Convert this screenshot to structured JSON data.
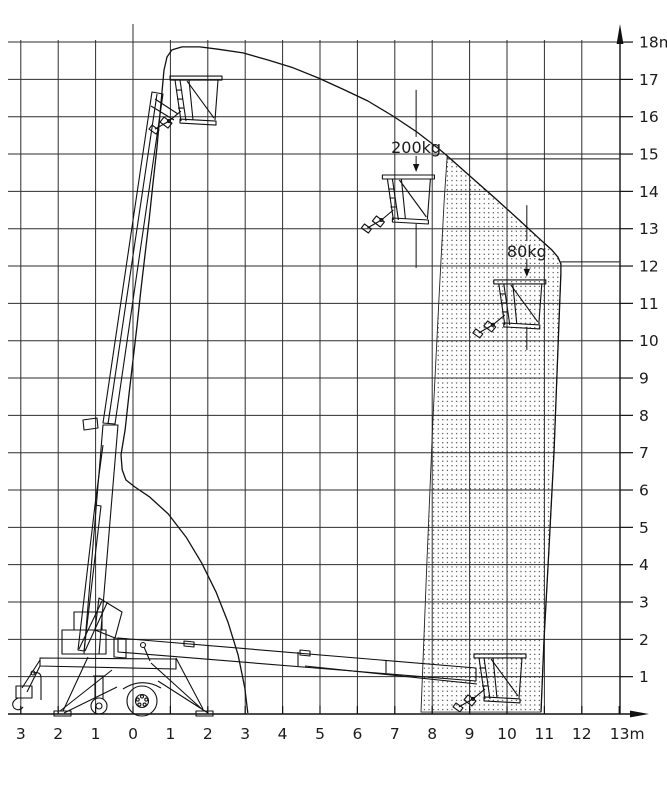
{
  "figure": {
    "kind": "aerial-work-platform-working-range-diagram"
  },
  "chart_data": {
    "type": "area",
    "grid": true,
    "x_axis": {
      "unit": "m",
      "tick_values": [
        -3,
        -2,
        -1,
        0,
        1,
        2,
        3,
        4,
        5,
        6,
        7,
        8,
        9,
        10,
        11,
        12,
        13
      ],
      "tick_labels": [
        "3",
        "2",
        "1",
        "0",
        "1",
        "2",
        "3",
        "4",
        "5",
        "6",
        "7",
        "8",
        "9",
        "10",
        "11",
        "12",
        "13m"
      ]
    },
    "y_axis": {
      "unit": "m",
      "tick_values": [
        1,
        2,
        3,
        4,
        5,
        6,
        7,
        8,
        9,
        10,
        11,
        12,
        13,
        14,
        15,
        16,
        17,
        18
      ],
      "tick_labels": [
        "1",
        "2",
        "3",
        "4",
        "5",
        "6",
        "7",
        "8",
        "9",
        "10",
        "11",
        "12",
        "13",
        "14",
        "15",
        "16",
        "17",
        "18m"
      ]
    },
    "envelope_m": [
      [
        3.07,
        0.03
      ],
      [
        2.99,
        0.7
      ],
      [
        2.81,
        1.58
      ],
      [
        2.54,
        2.46
      ],
      [
        2.22,
        3.27
      ],
      [
        1.84,
        4.04
      ],
      [
        1.42,
        4.74
      ],
      [
        0.94,
        5.36
      ],
      [
        0.45,
        5.81
      ],
      [
        0.05,
        6.08
      ],
      [
        -0.19,
        6.27
      ],
      [
        -0.29,
        6.54
      ],
      [
        -0.32,
        6.94
      ],
      [
        -0.21,
        7.61
      ],
      [
        -0.11,
        8.54
      ],
      [
        0.0,
        9.48
      ],
      [
        0.11,
        10.42
      ],
      [
        0.21,
        11.36
      ],
      [
        0.32,
        12.3
      ],
      [
        0.43,
        13.23
      ],
      [
        0.53,
        14.17
      ],
      [
        0.64,
        15.16
      ],
      [
        0.72,
        16.05
      ],
      [
        0.78,
        16.72
      ],
      [
        0.83,
        17.25
      ],
      [
        0.91,
        17.6
      ],
      [
        1.04,
        17.79
      ],
      [
        1.31,
        17.87
      ],
      [
        1.79,
        17.87
      ],
      [
        2.27,
        17.81
      ],
      [
        2.94,
        17.71
      ],
      [
        3.61,
        17.52
      ],
      [
        4.28,
        17.31
      ],
      [
        4.95,
        17.04
      ],
      [
        5.61,
        16.74
      ],
      [
        6.28,
        16.42
      ],
      [
        6.95,
        16.02
      ],
      [
        7.59,
        15.59
      ],
      [
        8.21,
        15.11
      ],
      [
        8.4,
        14.95
      ],
      [
        9.01,
        14.41
      ],
      [
        9.68,
        13.82
      ],
      [
        10.35,
        13.21
      ],
      [
        10.88,
        12.72
      ],
      [
        11.2,
        12.43
      ],
      [
        11.36,
        12.24
      ],
      [
        11.44,
        12.06
      ],
      [
        11.44,
        11.81
      ],
      [
        11.36,
        9.75
      ],
      [
        11.26,
        7.07
      ],
      [
        11.12,
        4.39
      ],
      [
        10.99,
        1.98
      ],
      [
        10.91,
        0.05
      ]
    ],
    "restricted_zone_m": [
      [
        8.4,
        14.95
      ],
      [
        9.01,
        14.41
      ],
      [
        9.68,
        13.82
      ],
      [
        10.35,
        13.21
      ],
      [
        10.88,
        12.72
      ],
      [
        11.2,
        12.43
      ],
      [
        11.36,
        12.24
      ],
      [
        11.44,
        12.06
      ],
      [
        11.44,
        11.81
      ],
      [
        11.36,
        9.75
      ],
      [
        11.26,
        7.07
      ],
      [
        11.12,
        4.39
      ],
      [
        10.99,
        1.98
      ],
      [
        10.91,
        0.05
      ],
      [
        7.7,
        0.05
      ],
      [
        7.86,
        4.13
      ],
      [
        8.02,
        7.88
      ],
      [
        8.18,
        11.09
      ],
      [
        8.32,
        13.77
      ]
    ],
    "leader_lines_m": [
      {
        "y": 14.87,
        "x_from": 8.4,
        "x_to": 13.0
      },
      {
        "y": 12.11,
        "x_from": 11.44,
        "x_to": 13.0
      }
    ],
    "load_callouts": [
      {
        "label": "200kg",
        "x_m": 7.57,
        "text_y_m": 15.03,
        "line_above_m": [
          16.72,
          15.46
        ],
        "arrow_m": [
          14.95,
          14.52
        ],
        "line_below_m": [
          13.13,
          11.95
        ]
      },
      {
        "label": "80kg",
        "x_m": 10.53,
        "text_y_m": 12.24,
        "line_above_m": [
          13.63,
          12.67
        ],
        "arrow_m": [
          12.19,
          11.71
        ],
        "line_below_m": [
          10.37,
          9.75
        ]
      }
    ],
    "platform_positions_m": [
      {
        "name": "platform-max-height",
        "x": 1.71,
        "floor_y": 15.83
      },
      {
        "name": "platform-200kg-zone",
        "x": 7.39,
        "floor_y": 13.18
      },
      {
        "name": "platform-80kg-zone",
        "x": 10.37,
        "floor_y": 10.37
      },
      {
        "name": "platform-stowed",
        "x": 9.84,
        "floor_y": 0.35
      }
    ]
  },
  "colors": {
    "ink": "#111111",
    "grid": "#2e2e2e",
    "background": "#ffffff"
  }
}
